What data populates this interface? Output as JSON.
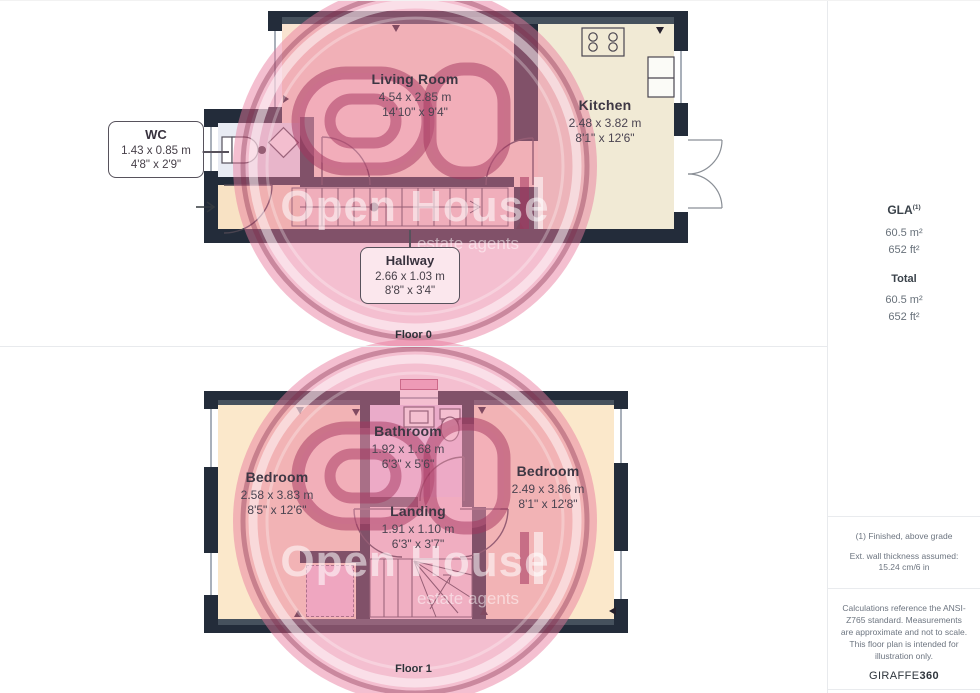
{
  "floor0": {
    "label": "Floor 0",
    "rooms": {
      "living_room": {
        "name": "Living Room",
        "metric": "4.54 x 2.85 m",
        "imperial": "14'10\" x 9'4\""
      },
      "kitchen": {
        "name": "Kitchen",
        "metric": "2.48 x 3.82 m",
        "imperial": "8'1\" x 12'6\""
      },
      "wc": {
        "name": "WC",
        "metric": "1.43 x 0.85 m",
        "imperial": "4'8\" x 2'9\""
      },
      "hallway": {
        "name": "Hallway",
        "metric": "2.66 x 1.03 m",
        "imperial": "8'8\" x 3'4\""
      }
    }
  },
  "floor1": {
    "label": "Floor 1",
    "rooms": {
      "bedroom_left": {
        "name": "Bedroom",
        "metric": "2.58 x 3.83 m",
        "imperial": "8'5\" x 12'6\""
      },
      "bathroom": {
        "name": "Bathroom",
        "metric": "1.92 x 1.68 m",
        "imperial": "6'3\" x 5'6\""
      },
      "bedroom_right": {
        "name": "Bedroom",
        "metric": "2.49 x 3.86 m",
        "imperial": "8'1\" x 12'8\""
      },
      "landing": {
        "name": "Landing",
        "metric": "1.91 x 1.10 m",
        "imperial": "6'3\" x 3'7\""
      }
    }
  },
  "sidebar": {
    "gla_label": "GLA",
    "gla_sup": "(1)",
    "gla_m2": "60.5 m²",
    "gla_ft2": "652 ft²",
    "total_label": "Total",
    "total_m2": "60.5 m²",
    "total_ft2": "652 ft²",
    "footnote1": "(1) Finished, above grade",
    "footnote2": "Ext. wall thickness assumed: 15.24 cm/6 in",
    "disclaimer": "Calculations reference the ANSI-Z765 standard. Measurements are approximate and not to scale. This floor plan is intended for illustration only.",
    "brand_giraffe": "GIRAFFE",
    "brand_360": "360"
  },
  "watermark": {
    "line1": "Open House",
    "line2": "estate agents"
  },
  "colors": {
    "wall": "#232c3a",
    "kitchen_floor": "#f1ead5",
    "bedroom_floor": "#fbe8cb",
    "living_floor": "#f9e3d0",
    "wc_floor": "#e8ebf3",
    "bathroom_floor": "#ecd9f2",
    "watermark_pink": "#e8799d"
  }
}
